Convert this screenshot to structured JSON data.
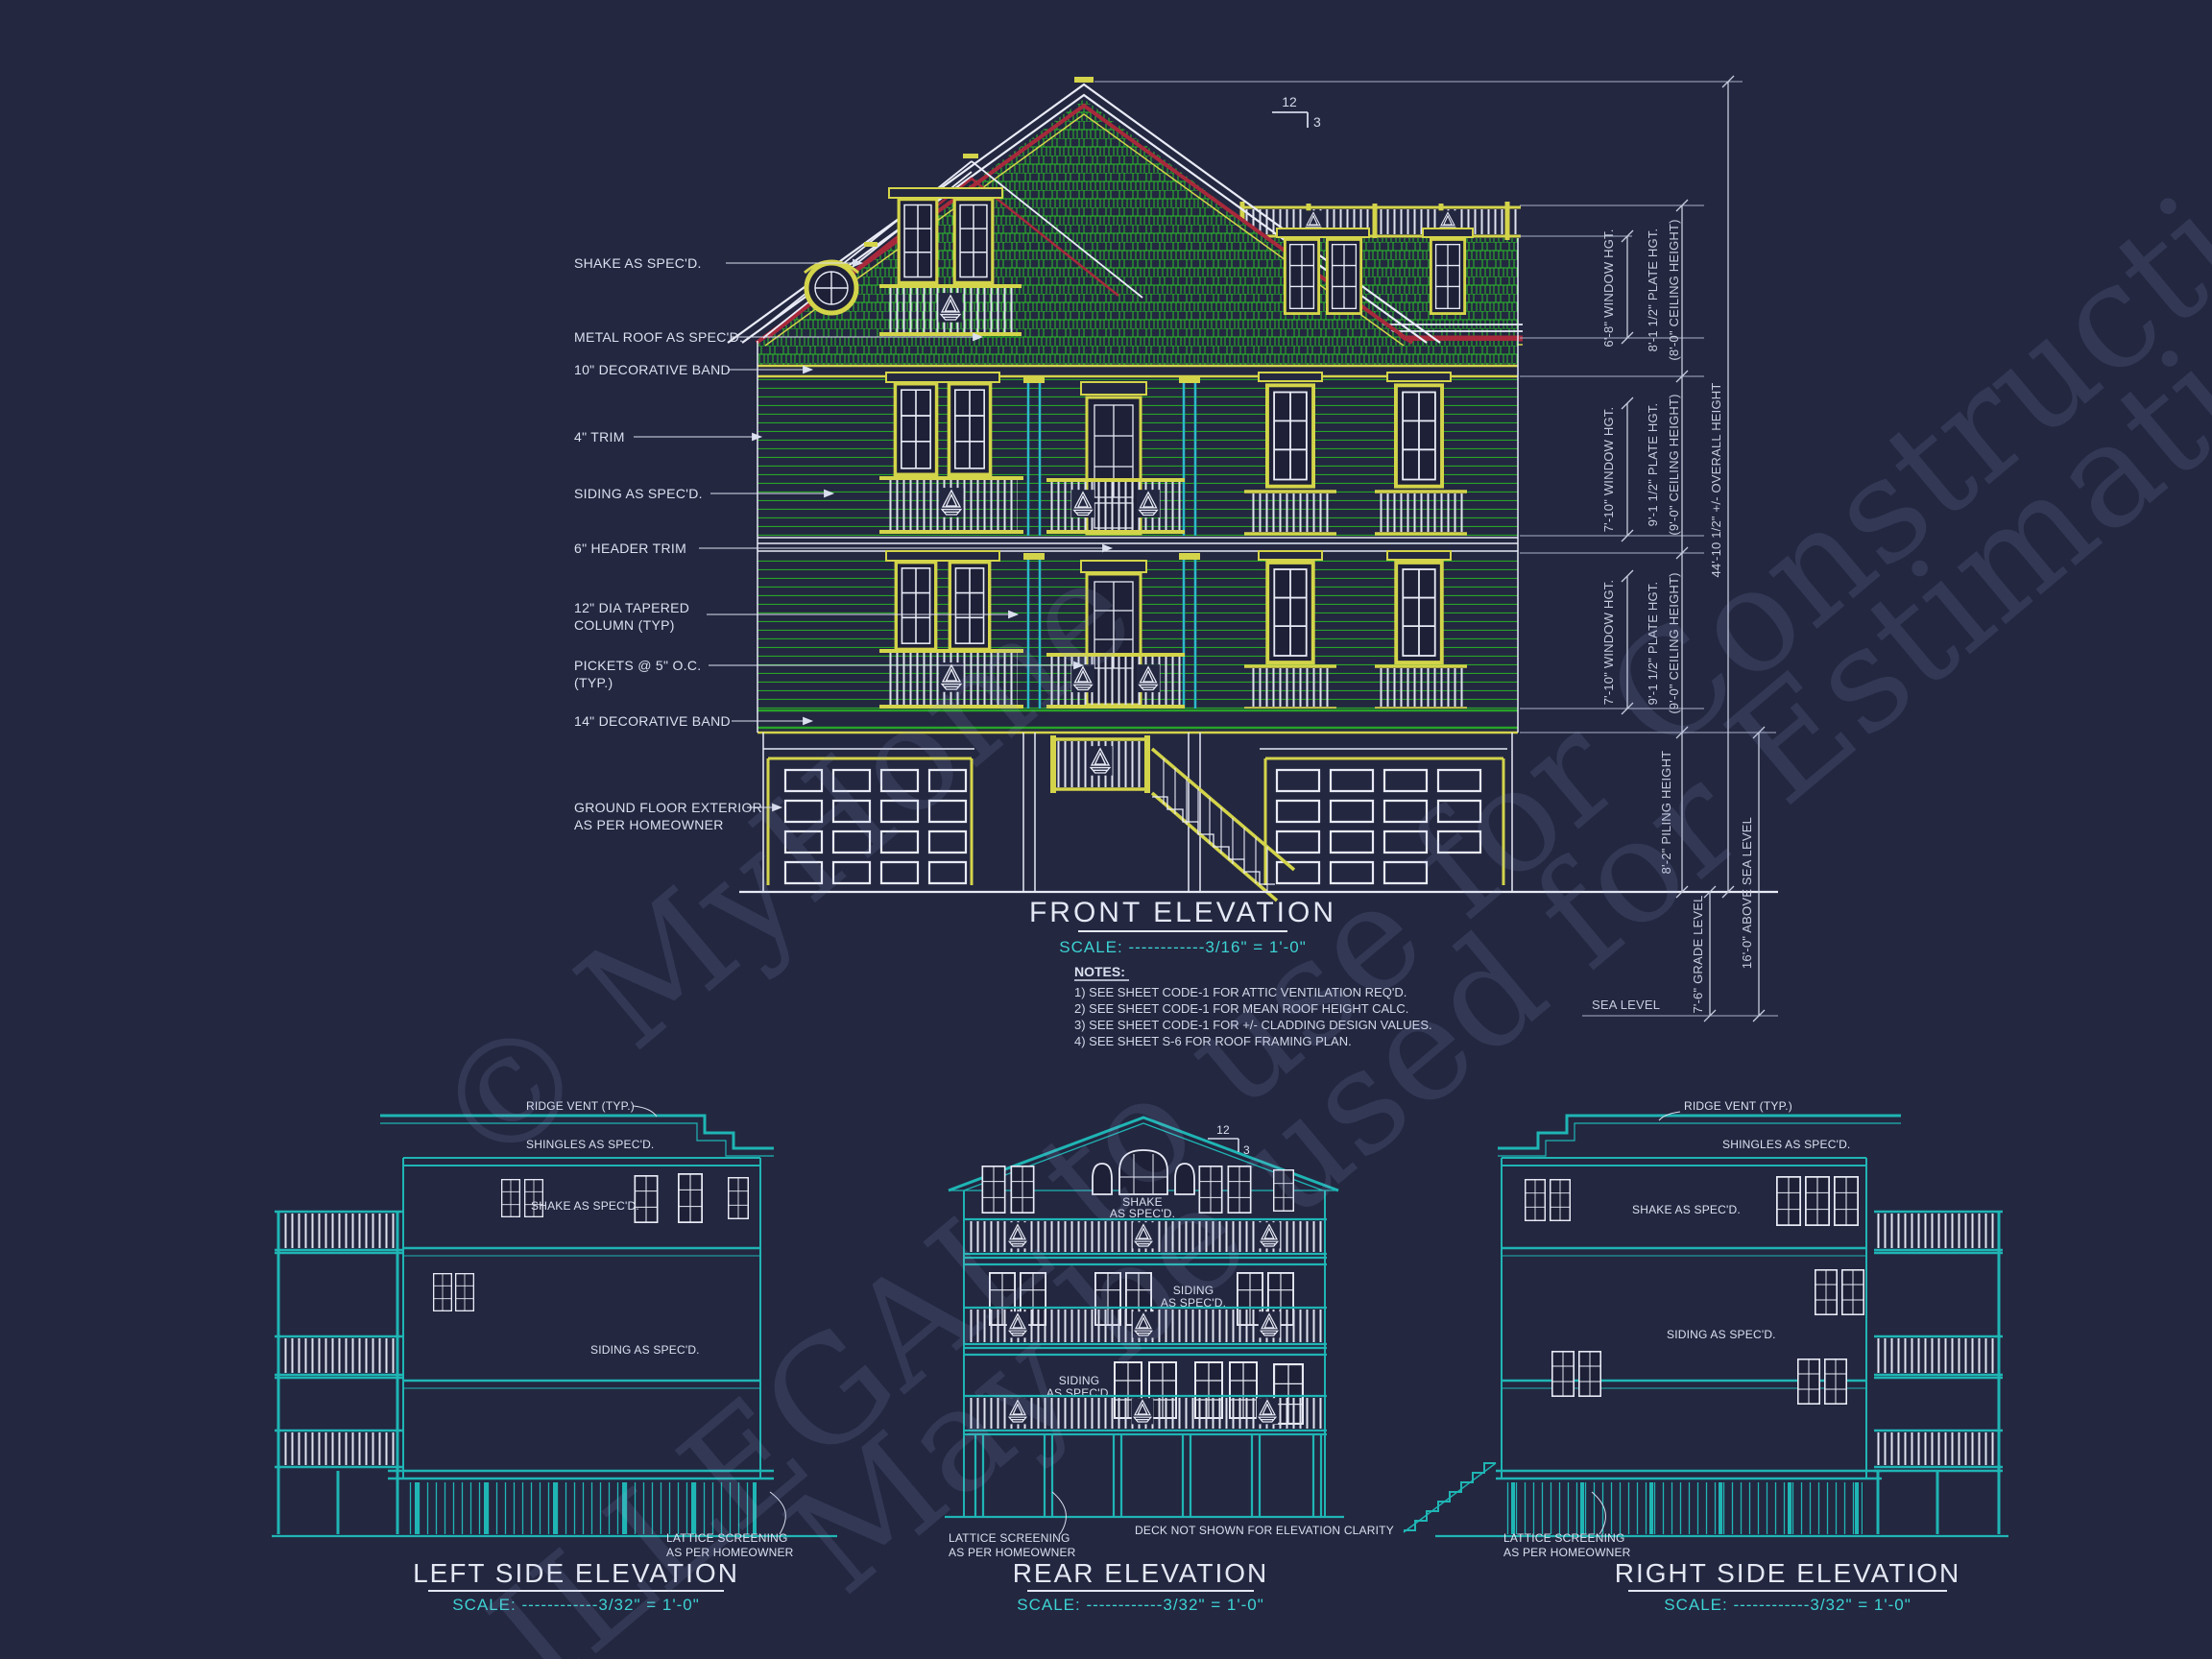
{
  "colors": {
    "background": "#232740",
    "green": "#2bbf2b",
    "yellow": "#d4d44a",
    "cyan_column": "#2cb9c9",
    "teal": "#1fb5b5",
    "white_line": "#e8ebf5",
    "roof_red": "#a8293b",
    "label_text": "#dbe0ef",
    "scale_text": "#3dd3d3"
  },
  "watermark": {
    "line1": "© MyHome",
    "line2": "ILLEGAL to use for Construction",
    "line3": "May be used for Estimations"
  },
  "front": {
    "title": "FRONT ELEVATION",
    "scale": "SCALE: ------------3/16\" = 1'-0\"",
    "pitch_rise": "12",
    "pitch_run": "3",
    "callouts": [
      {
        "l1": "SHAKE AS SPEC'D.",
        "l2": ""
      },
      {
        "l1": "METAL ROOF AS SPEC'D.",
        "l2": ""
      },
      {
        "l1": "10\" DECORATIVE BAND",
        "l2": ""
      },
      {
        "l1": "4\" TRIM",
        "l2": ""
      },
      {
        "l1": "SIDING AS SPEC'D.",
        "l2": ""
      },
      {
        "l1": "6\" HEADER TRIM",
        "l2": ""
      },
      {
        "l1": "12\" DIA TAPERED",
        "l2": "COLUMN (TYP)"
      },
      {
        "l1": "PICKETS @ 5\" O.C.",
        "l2": "(TYP.)"
      },
      {
        "l1": "14\" DECORATIVE BAND",
        "l2": ""
      },
      {
        "l1": "GROUND FLOOR EXTERIOR",
        "l2": "AS PER HOMEOWNER"
      }
    ],
    "dims": {
      "window_hgt_top": "6'-8\" WINDOW HGT.",
      "plate_top_1": "8'-1 1/2\" PLATE HGT.",
      "plate_top_2": "(8'-0\" CEILING HEIGHT)",
      "window_hgt_mid": "7'-10\" WINDOW HGT.",
      "plate_mid_1": "9'-1 1/2\" PLATE HGT.",
      "plate_mid_2": "(9'-0\" CEILING HEIGHT)",
      "window_hgt_low": "7'-10\" WINDOW HGT.",
      "plate_low_1": "9'-1 1/2\" PLATE HGT.",
      "plate_low_2": "(9'-0\" CEILING HEIGHT)",
      "piling": "8'-2\" PILING HEIGHT",
      "overall": "44'-10 1/2\" +/- OVERALL HEIGHT",
      "above_sea": "16'-0\" ABOVE SEA LEVEL",
      "grade": "7'-6\" GRADE LEVEL",
      "sea_level": "SEA LEVEL"
    },
    "notes_heading": "NOTES:",
    "notes": [
      "1)  SEE SHEET CODE-1 FOR ATTIC VENTILATION REQ'D.",
      "2)  SEE SHEET CODE-1 FOR MEAN ROOF HEIGHT CALC.",
      "3)  SEE SHEET CODE-1 FOR +/- CLADDING DESIGN VALUES.",
      "4)  SEE SHEET S-6 FOR ROOF FRAMING PLAN."
    ]
  },
  "left_elev": {
    "title": "LEFT SIDE ELEVATION",
    "scale": "SCALE: ------------3/32\" = 1'-0\"",
    "labels": {
      "ridge_vent": "RIDGE VENT (TYP.)",
      "shingles": "SHINGLES AS SPEC'D.",
      "shake": "SHAKE AS SPEC'D.",
      "siding": "SIDING AS SPEC'D.",
      "lattice1": "LATTICE SCREENING",
      "lattice2": "AS PER HOMEOWNER"
    }
  },
  "rear_elev": {
    "title": "REAR ELEVATION",
    "scale": "SCALE: ------------3/32\" = 1'-0\"",
    "pitch_rise": "12",
    "pitch_run": "3",
    "labels": {
      "shake1": "SHAKE",
      "shake2": "AS SPEC'D.",
      "siding_a1": "SIDING",
      "siding_a2": "AS SPEC'D.",
      "siding_b1": "SIDING",
      "siding_b2": "AS SPEC'D.",
      "lattice1": "LATTICE SCREENING",
      "lattice2": "AS PER HOMEOWNER",
      "deck_note": "DECK NOT SHOWN FOR ELEVATION CLARITY"
    }
  },
  "right_elev": {
    "title": "RIGHT SIDE ELEVATION",
    "scale": "SCALE: ------------3/32\" = 1'-0\"",
    "labels": {
      "ridge_vent": "RIDGE VENT (TYP.)",
      "shingles": "SHINGLES AS SPEC'D.",
      "shake": "SHAKE AS SPEC'D.",
      "siding": "SIDING AS SPEC'D.",
      "lattice1": "LATTICE SCREENING",
      "lattice2": "AS PER HOMEOWNER"
    }
  }
}
